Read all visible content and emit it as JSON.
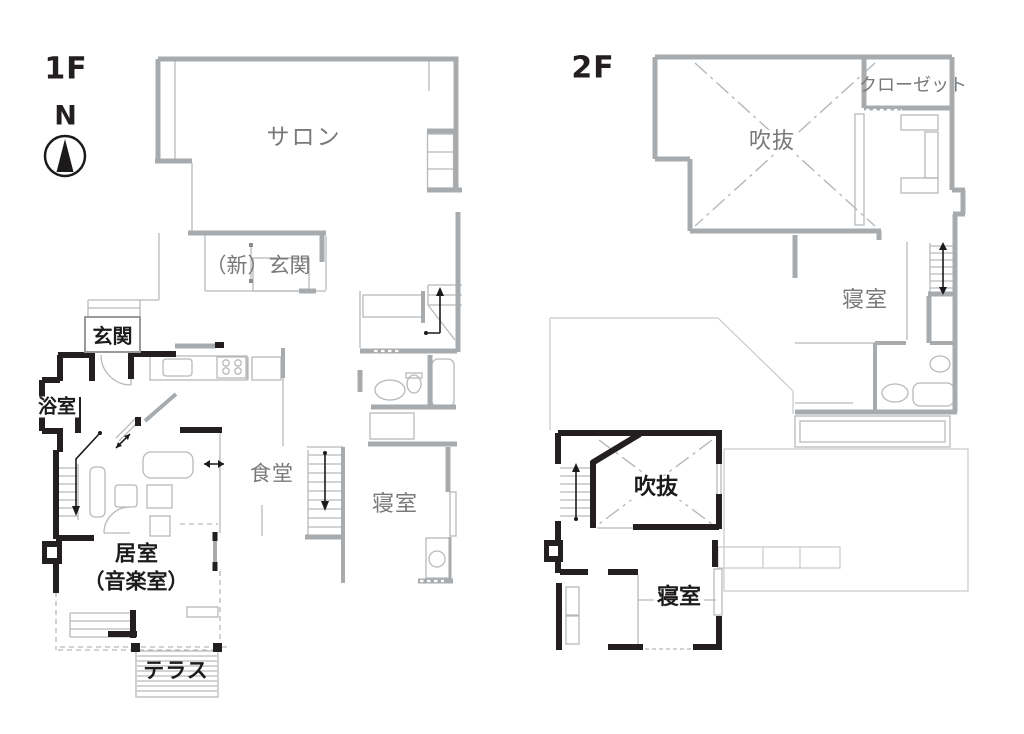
{
  "page": {
    "background": "#ffffff"
  },
  "legend_colors": {
    "existing_wall_gray": "#a8abad",
    "new_wall_black": "#231f20",
    "label_gray": "#77797b",
    "label_black": "#1d1a1b"
  },
  "compass": {
    "label": "N"
  },
  "plans": {
    "f1": {
      "title": "1F",
      "rooms": [
        {
          "id": "salon",
          "label": "サロン"
        },
        {
          "id": "new-entrance",
          "label": "（新）玄関"
        },
        {
          "id": "entrance",
          "label": "玄関"
        },
        {
          "id": "bathroom",
          "label": "浴室"
        },
        {
          "id": "dining",
          "label": "食堂"
        },
        {
          "id": "bedroom",
          "label": "寝室"
        },
        {
          "id": "living-music-room",
          "label": "居室",
          "sublabel": "（音楽室）"
        },
        {
          "id": "terrace",
          "label": "テラス"
        }
      ]
    },
    "f2": {
      "title": "2F",
      "rooms": [
        {
          "id": "closet",
          "label": "クローゼット"
        },
        {
          "id": "void-upper",
          "label": "吹抜"
        },
        {
          "id": "bedroom-upper",
          "label": "寝室"
        },
        {
          "id": "void-lower",
          "label": "吹抜"
        },
        {
          "id": "bedroom-lower",
          "label": "寝室"
        }
      ]
    }
  }
}
